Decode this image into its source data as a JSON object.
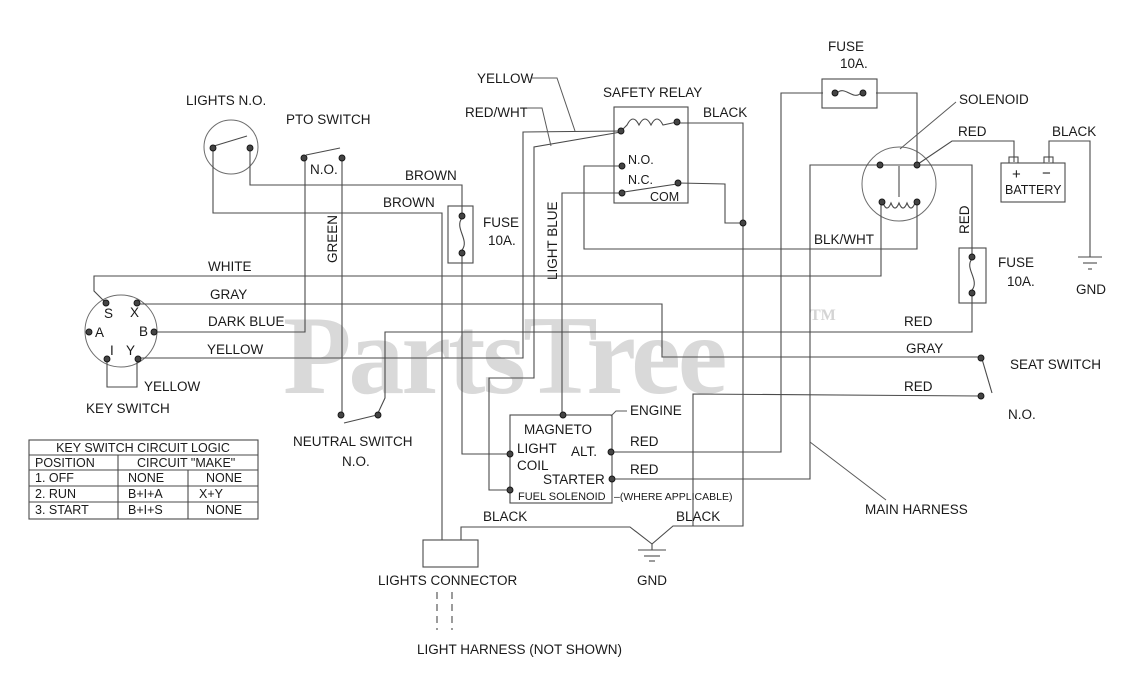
{
  "watermark": {
    "text": "PartsTree",
    "tm": "TM"
  },
  "colors": {
    "wire": "#4a4a4a",
    "text": "#1a1a1a",
    "watermark": "#d9d9d9",
    "background": "#ffffff"
  },
  "labels": {
    "lights_no": "LIGHTS N.O.",
    "pto_switch": "PTO SWITCH",
    "n_o": "N.O.",
    "brown": "BROWN",
    "fuse": "FUSE",
    "fuse_amps": "10A.",
    "yellow": "YELLOW",
    "red_wht": "RED/WHT",
    "safety_relay": "SAFETY RELAY",
    "black": "BLACK",
    "n_c": "N.C.",
    "com": "COM",
    "light_blue": "LIGHT BLUE",
    "green": "GREEN",
    "solenoid": "SOLENOID",
    "red": "RED",
    "battery": "BATTERY",
    "plus": "+",
    "minus": "−",
    "blk_wht": "BLK/WHT",
    "gnd": "GND",
    "white": "WHITE",
    "gray": "GRAY",
    "dark_blue": "DARK BLUE",
    "key_switch": "KEY SWITCH",
    "seat_switch": "SEAT SWITCH",
    "neutral_switch": "NEUTRAL SWITCH",
    "magneto": "MAGNETO",
    "light": "LIGHT",
    "coil": "COIL",
    "alt": "ALT.",
    "starter": "STARTER",
    "fuel_solenoid": "FUEL SOLENOID",
    "where_applicable": "–(WHERE APPLICABLE)",
    "engine": "ENGINE",
    "main_harness": "MAIN HARNESS",
    "lights_connector": "LIGHTS CONNECTOR",
    "light_harness": "LIGHT HARNESS (NOT SHOWN)"
  },
  "key_switch_terminals": {
    "s": "S",
    "x": "X",
    "a": "A",
    "b": "B",
    "i": "I",
    "y": "Y"
  },
  "logic_table": {
    "title": "KEY SWITCH CIRCUIT LOGIC",
    "col_position": "POSITION",
    "col_circuit": "CIRCUIT \"MAKE\"",
    "rows": [
      {
        "position": "1. OFF",
        "circuit": "NONE",
        "make": "NONE"
      },
      {
        "position": "2. RUN",
        "circuit": "B+I+A",
        "make": "X+Y"
      },
      {
        "position": "3. START",
        "circuit": "B+I+S",
        "make": "NONE"
      }
    ]
  }
}
